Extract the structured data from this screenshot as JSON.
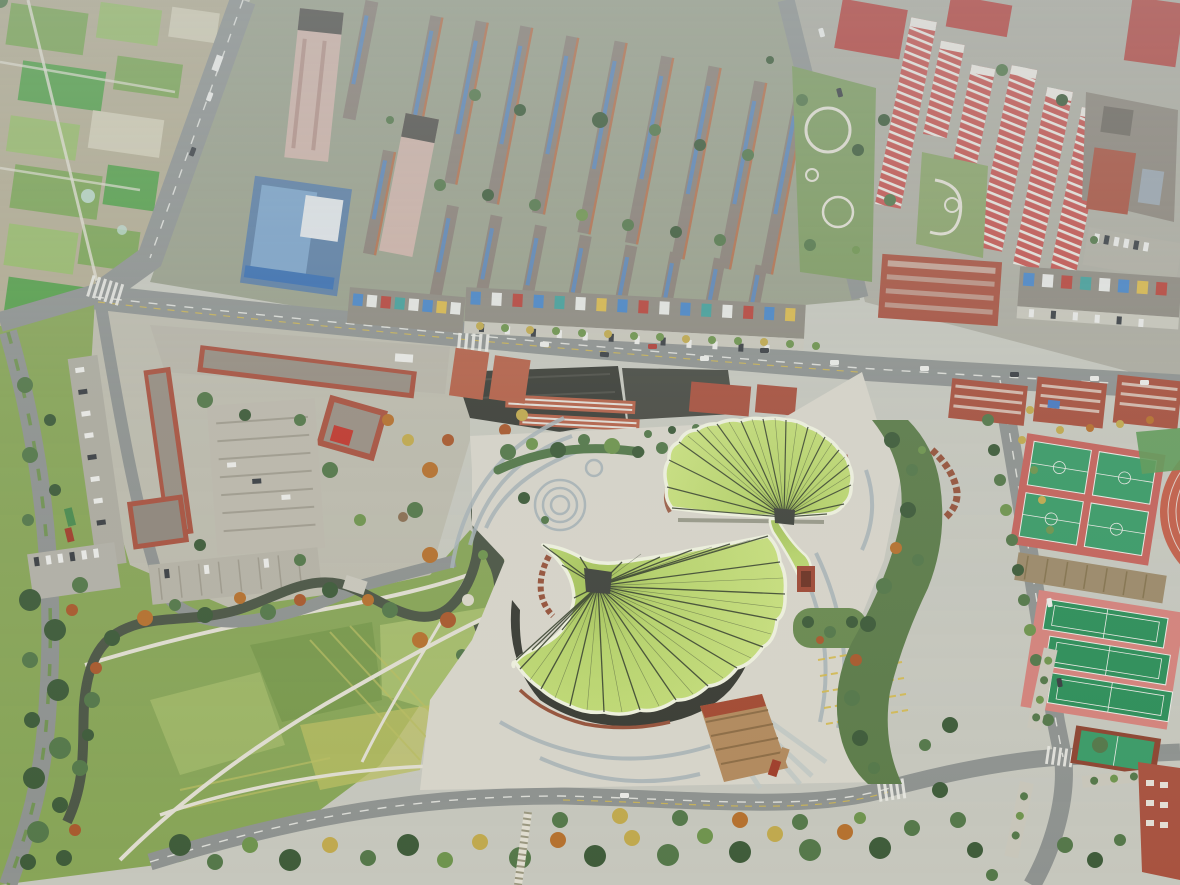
{
  "image": {
    "kind": "aerial-photograph",
    "view": "high oblique top-down drone view",
    "subject": "Cultural center with two giant ginkgo-leaf shaped fan roofs in a landscaped park plaza",
    "surroundings": [
      "vegetable farmland plots top-left",
      "mid-rise residential rows with solar water heaters top-center",
      "red-and-white striped apartment towers top-right",
      "red-brick campus with courtyard parking middle-left",
      "winding dark stream with autumn-colored trees",
      "open meadow with footpaths bottom-left",
      "basketball courts, tennis courts and running track right side",
      "tree-lined roads with intersections and crosswalks"
    ],
    "season": "late autumn, hazy daylight"
  },
  "colors": {
    "base": "#c6c7bd",
    "haze": "#bcc6cb",
    "farmTan": "#b3ac92",
    "farmGreen1": "#7da556",
    "farmGreen2": "#99ba6b",
    "farmBright": "#57a04b",
    "farmPale": "#cfcab2",
    "resBase": "#9aa08b",
    "roofGray": "#8b8177",
    "solarBlue": "#5e86b5",
    "wallOrange": "#b4724e",
    "pinkTower": "#cdb2a7",
    "towerDark": "#55534d",
    "blueGlass": "#5d7fa4",
    "blueGlass2": "#7ca3c8",
    "road": "#8f9390",
    "roadLine": "#e9e9e3",
    "roadYellow": "#d3b94e",
    "sidewalk": "#c8c6ba",
    "shopRoof": "#8f8b80",
    "signBlue": "#4a86c6",
    "signRed": "#b8463c",
    "signWhite": "#e5e6e2",
    "signTeal": "#46a09a",
    "signYellow": "#d8b84e",
    "darkRoof": "#3e4039",
    "darkRoof2": "#4b4d45",
    "brickRed": "#a85340",
    "brickDark": "#8e4632",
    "dormRed": "#b5634a",
    "redSlab": "#c45550",
    "slabWhite": "#e8e4dc",
    "grayBldg": "#8d867b",
    "parkGreen": "#7f9c61",
    "treeDark": "#3f5c3a",
    "treeMid": "#55784a",
    "treeLight": "#6f944e",
    "treeYellow": "#c0a94e",
    "treeOrange": "#b5712f",
    "treeRust": "#a85a2e",
    "meadow": "#88a558",
    "meadowLight": "#a6bc6c",
    "meadowDark": "#7a9a4e",
    "meadowYellow": "#b9bd62",
    "pathLight": "#e0ddd0",
    "water": "#4d5746",
    "plaza": "#d7d4c9",
    "plazaBand": "#a7b2b6",
    "plazaBand2": "#bfc7c3",
    "leafTrim": "#eef0dd",
    "leafIn": "#a2bf58",
    "leafMid": "#b7d36c",
    "leafOut": "#c9e07f",
    "rib": "#3a4430",
    "pivotDark": "#42453e",
    "facadeDark": "#3b3d35",
    "baseRed": "#96543c",
    "rampTan": "#b28a5e",
    "rampRed": "#a03f2c",
    "courtRed": "#c4645c",
    "courtGreen": "#3c9b68",
    "tennisPink": "#d4837c",
    "tennisGreen": "#2f8f5a",
    "trackRed": "#c2604a",
    "trackGreen": "#5f9a58",
    "dirt": "#9c8a6a",
    "carWhite": "#e9e9e5",
    "carDark": "#3c4044",
    "canopyTeal": "#3f8f86",
    "truckRed": "#a03f2c",
    "truckGreen": "#4a8a4e"
  },
  "landmark": {
    "name": "ginkgo-leaf pavilions",
    "large_leaf_pivot": [
      598,
      586
    ],
    "small_leaf_pivot": [
      784,
      517
    ],
    "roof_style": "fan of radiating dark ribs on yellow-green metal roof with white scalloped trim",
    "base": "dark vertical louver facade with terracotta colonnades and a tan service ramp"
  }
}
